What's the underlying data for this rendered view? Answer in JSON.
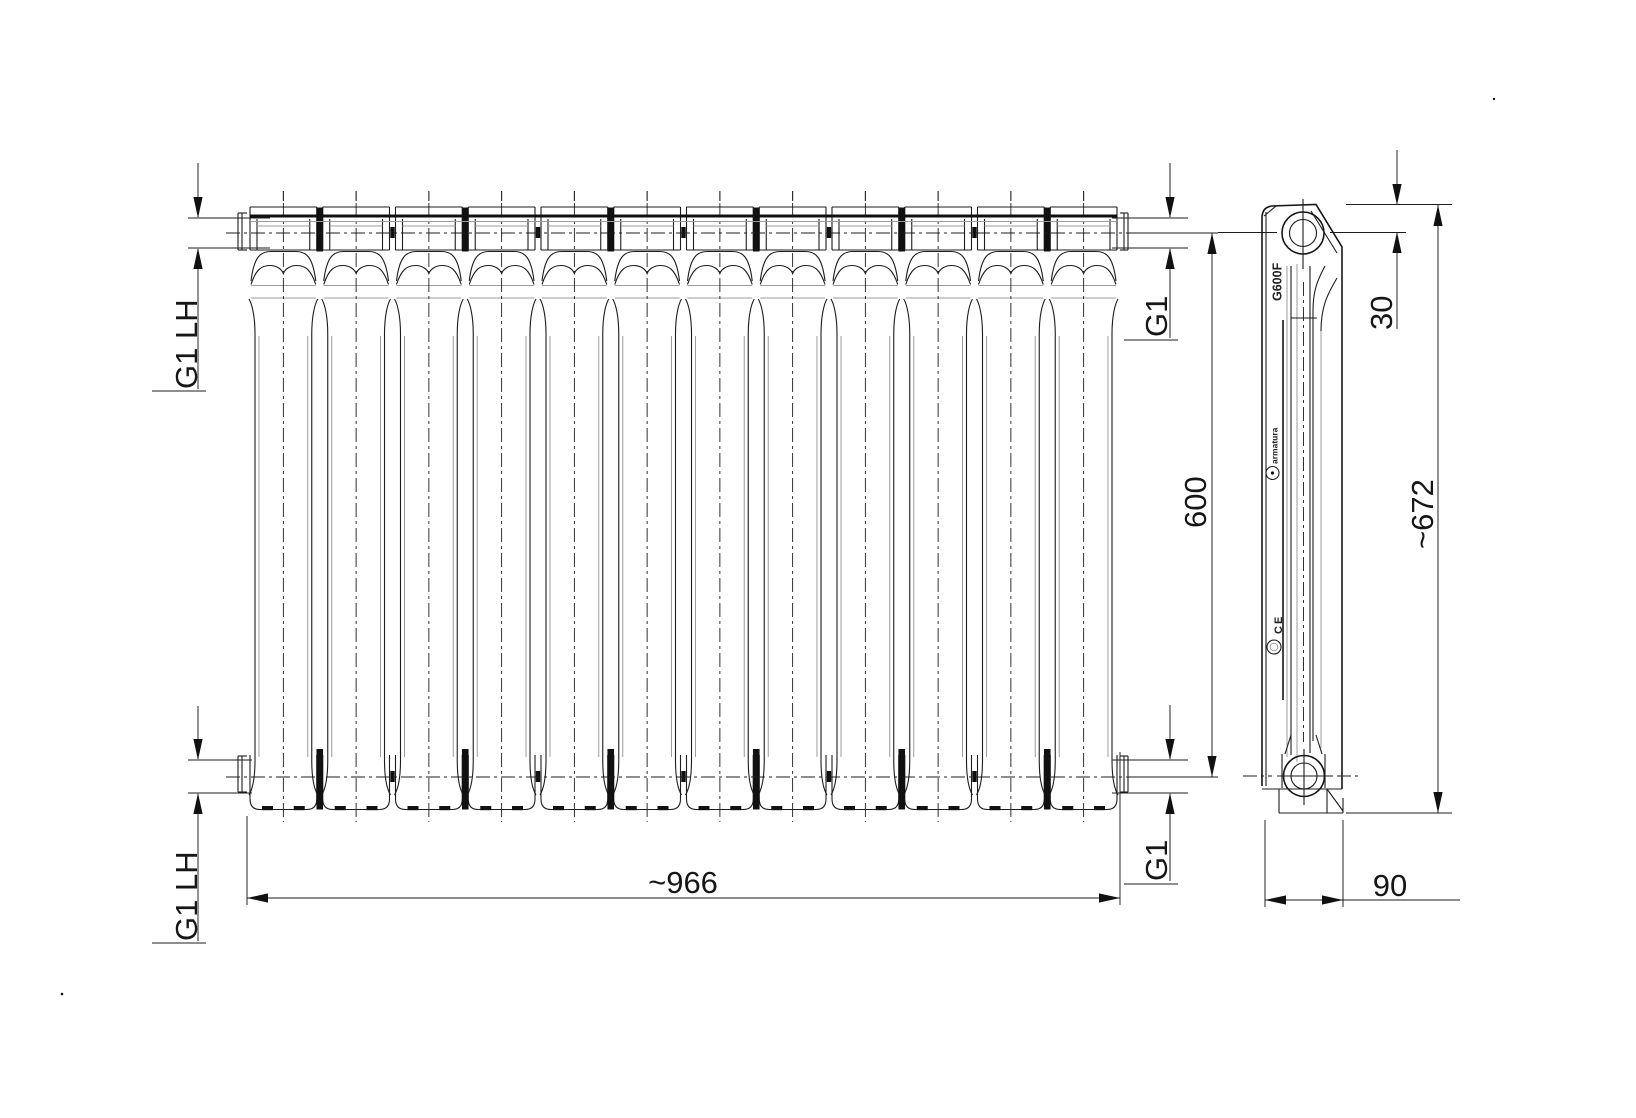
{
  "front_view": {
    "section_count": 12,
    "connections": {
      "top_left": "G1 LH",
      "bottom_left": "G1 LH",
      "top_right": "G1",
      "bottom_right": "G1"
    }
  },
  "side_view": {
    "markings": {
      "model": "G600F",
      "brand": "armatura",
      "ce_mark": "CE"
    }
  },
  "dimensions": {
    "overall_width": "~966",
    "axis_spacing": "600",
    "overall_height": "~672",
    "depth": "90",
    "port_offset_from_top": "30"
  }
}
